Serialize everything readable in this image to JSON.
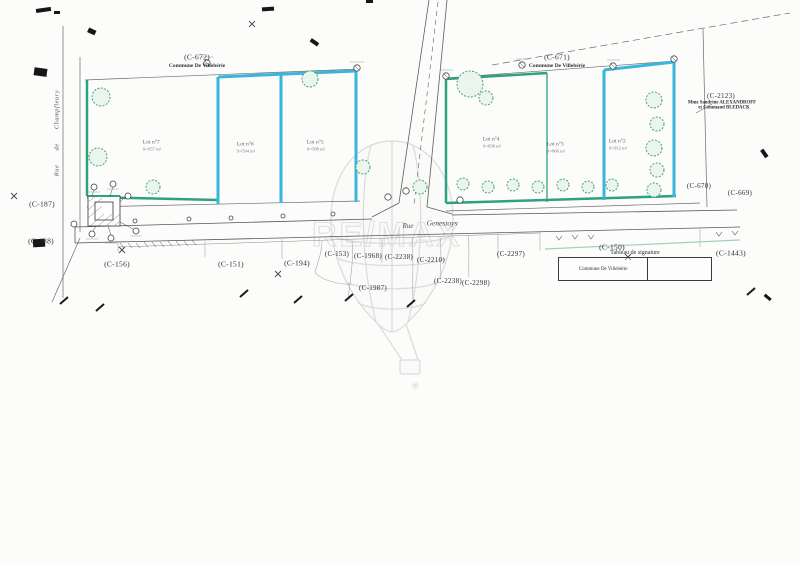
{
  "watermark": {
    "letters": "RE/MAX",
    "registered": "®"
  },
  "streets": {
    "vertical": "Rue de Champfleury",
    "horizontal_prefix": "Rue",
    "horizontal_name": "Genestoys"
  },
  "top_annotations": [
    {
      "ref": "(C-672)",
      "owner": "Commune De Villebérie"
    },
    {
      "ref": "(C-671)",
      "owner": "Commune De Villebérie"
    },
    {
      "ref": "(C-2123)",
      "owner_line1": "Mme Sandrine ALEXANDROFF",
      "owner_line2": "et Command BLEDACK"
    }
  ],
  "parcel_refs": [
    "(C-187)",
    "(C-188)",
    "(C-156)",
    "(C-151)",
    "(C-194)",
    "(C-153)",
    "(C-1968)",
    "(C-2238)",
    "(C-2210)",
    "(C-1987)",
    "(C-2238)",
    "(C-2298)",
    "(C-2297)",
    "(C-150)",
    "(C-1443)",
    "(C-670)",
    "(C-669)"
  ],
  "lots": [
    {
      "name": "Lot n°7",
      "area": "S=957 m²"
    },
    {
      "name": "Lot n°6",
      "area": "S=594 m²"
    },
    {
      "name": "Lot n°5",
      "area": "S=588 m²"
    },
    {
      "name": "Lot n°4",
      "area": "S=838 m²"
    },
    {
      "name": "Lot n°3",
      "area": "S=866 m²"
    },
    {
      "name": "Lot n°2",
      "area": "S=912 m²"
    }
  ],
  "signature_table": {
    "title": "Tableau de signature",
    "cells": [
      "Commune De Villebérie",
      ""
    ]
  },
  "colors": {
    "parcel_green": "#2ea182",
    "parcel_cyan": "#3ab5de",
    "tree_green": "#4aa368",
    "ink": "#3a3a40",
    "watermark_gray": "#dedede"
  }
}
